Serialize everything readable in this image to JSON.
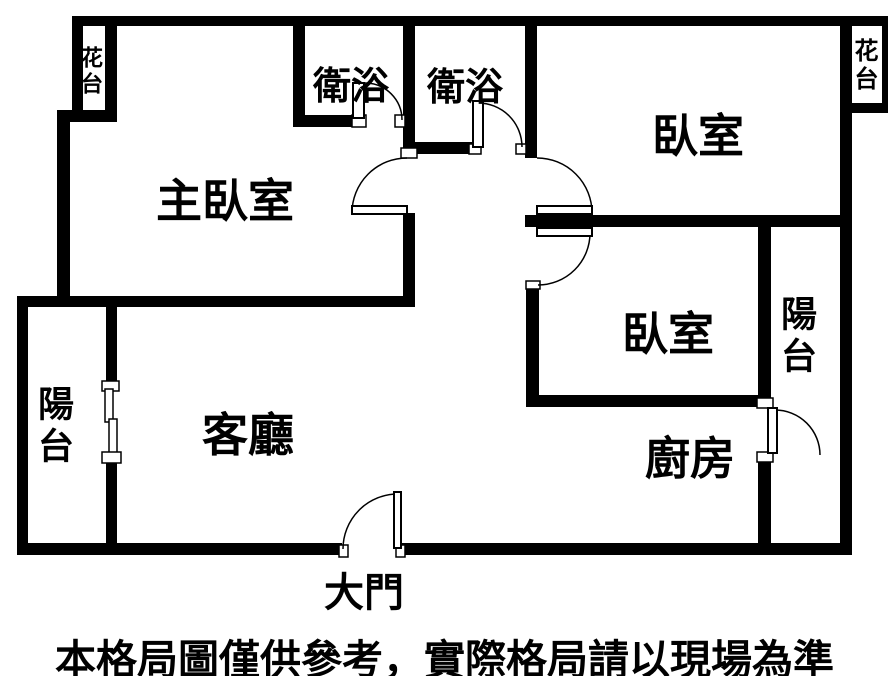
{
  "rooms": {
    "master_bedroom": {
      "label": "主臥室"
    },
    "bedroom_top": {
      "label": "臥室"
    },
    "bedroom_mid": {
      "label": "臥室"
    },
    "living_room": {
      "label": "客廳"
    },
    "kitchen": {
      "label": "廚房"
    },
    "bath_left": {
      "label": "衛浴"
    },
    "bath_right": {
      "label": "衛浴"
    },
    "balcony_left": {
      "label": "陽台"
    },
    "balcony_right": {
      "label": "陽台"
    },
    "flower_bed_left": {
      "label": "花台"
    },
    "flower_bed_right": {
      "label": "花台"
    }
  },
  "entrance": {
    "label": "大門"
  },
  "footer": {
    "disclaimer": "本格局圖僅供參考，實際格局請以現場為準"
  },
  "colors": {
    "wall": "#000000",
    "background": "#ffffff",
    "text": "#000000"
  }
}
